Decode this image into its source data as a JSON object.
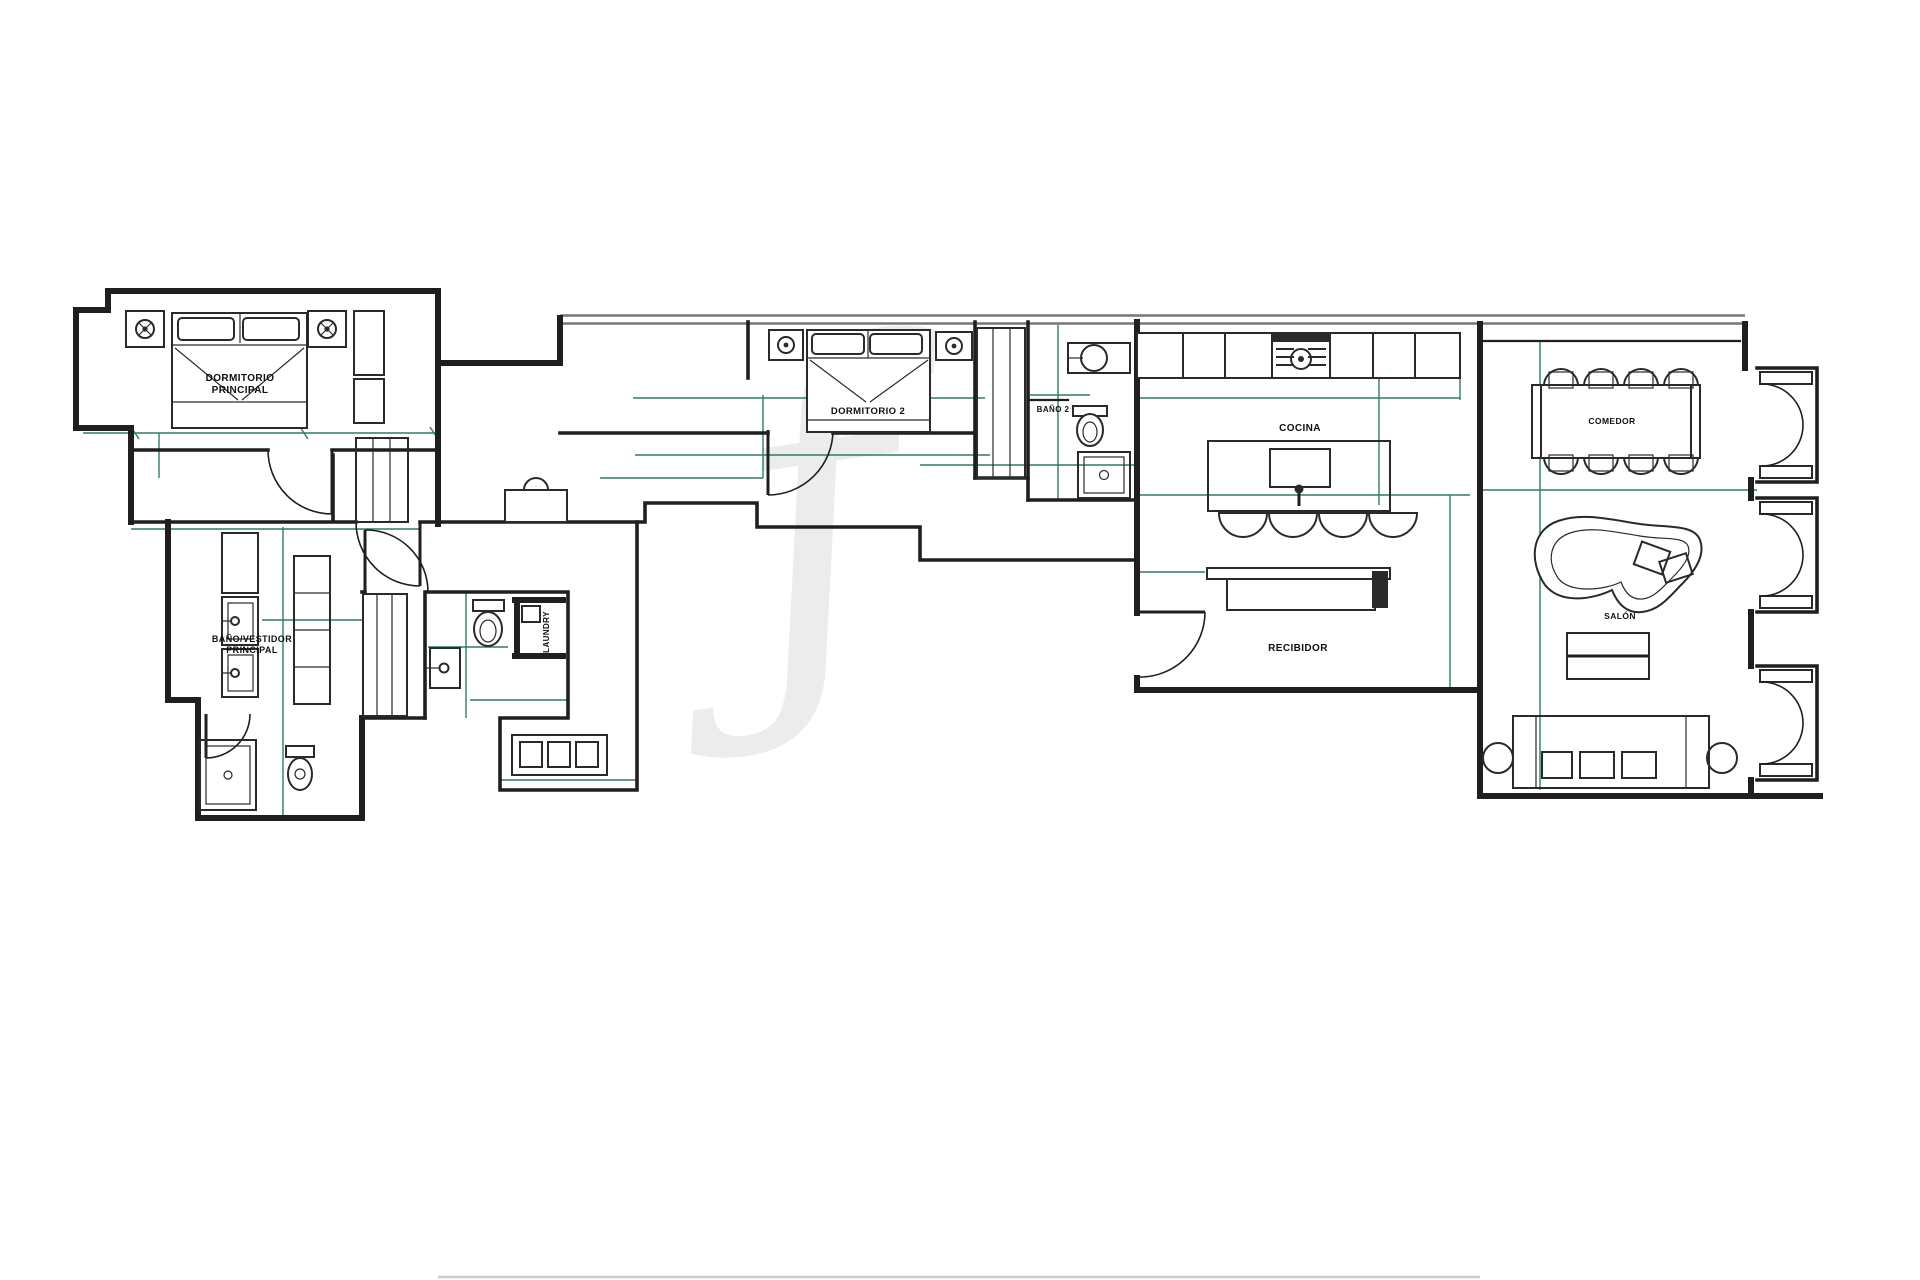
{
  "colors": {
    "background": "#ffffff",
    "walls": "#1f1f1f",
    "walls_soft": "#777777",
    "dimensions": "#2e7d64",
    "furniture": "#2a2a2a",
    "watermark": "#ececec",
    "labels": "#101010",
    "page_edge": "#cccccc"
  },
  "watermark": {
    "glyph": "ƒ"
  },
  "rooms": {
    "dormitorio_principal": {
      "line1": "DORMITORIO",
      "line2": "PRINCIPAL"
    },
    "bano_vestidor": {
      "line1": "BAÑO/VESTIDOR",
      "line2": "PRINCIPAL"
    },
    "laundry": {
      "label": "LAUNDRY"
    },
    "dormitorio_2": {
      "label": "DORMITORIO 2"
    },
    "bano_2": {
      "label": "BAÑO 2"
    },
    "cocina": {
      "label": "COCINA"
    },
    "recibidor": {
      "label": "RECIBIDOR"
    },
    "comedor": {
      "label": "COMEDOR"
    },
    "salon": {
      "label": "SALÓN"
    }
  }
}
